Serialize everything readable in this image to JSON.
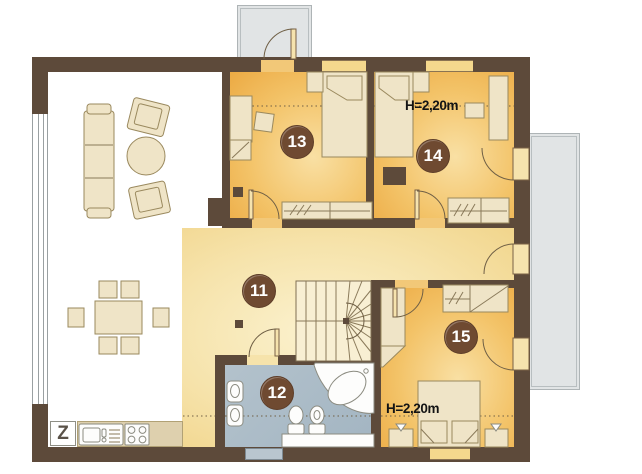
{
  "plan": {
    "rooms": [
      {
        "number": "11"
      },
      {
        "number": "12"
      },
      {
        "number": "13"
      },
      {
        "number": "14",
        "ceiling_height_label": "H=2,20m"
      },
      {
        "number": "15",
        "ceiling_height_label": "H=2,20m"
      }
    ],
    "annotations": {
      "kitchen_symbol": "Z"
    },
    "palette": {
      "wall": "#5d4a3a",
      "bedroom_floor_dark": "#ecaa43",
      "bedroom_floor_light": "#f9e0a4",
      "hall_floor_light": "#fbf2cf",
      "hall_floor_dark": "#f1d489",
      "bathroom_floor": "#a9bac6",
      "living_floor": "#ffffff",
      "outdoor_gray": "#e1e4e5",
      "furniture_fill": "#efe4c7",
      "furniture_stroke": "#9a895e",
      "fixture_white": "#fdfdfc",
      "badge_brown": "#6f4a31",
      "badge_text": "#ffffff",
      "counter_tan": "#ded0ae",
      "window_strip": "#f4d88d"
    }
  }
}
